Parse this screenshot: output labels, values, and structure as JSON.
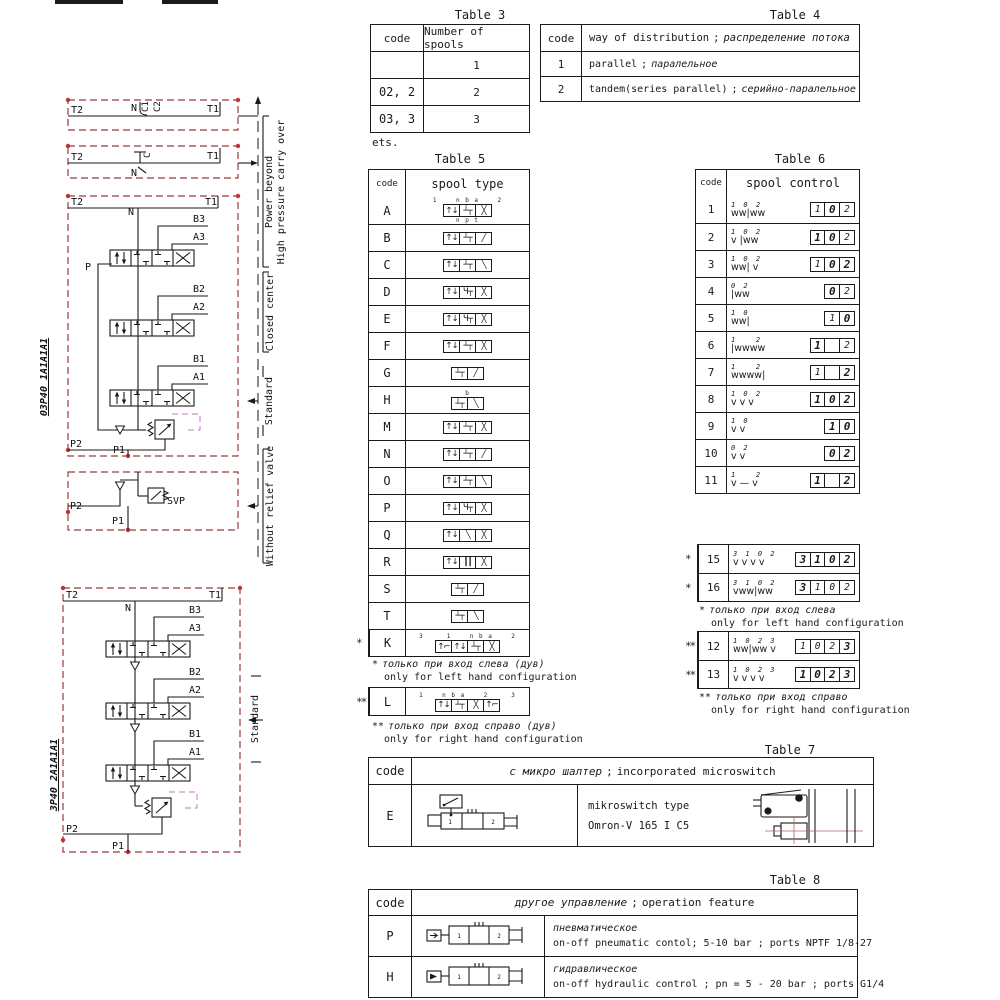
{
  "titles": {
    "t3": "Table 3",
    "t4": "Table 4",
    "t5": "Table 5",
    "t6": "Table 6",
    "t7": "Table 7",
    "t8": "Table 8"
  },
  "misc": {
    "sep": ";",
    "v1": "1",
    "v2": "2"
  },
  "colors": {
    "line": "#1a1a1a",
    "diagram_dash_red": "#9c3a3a",
    "port_dot_red": "#c23232",
    "relief_magenta": "#cf8fd0"
  },
  "table3": {
    "headers": [
      "code",
      "Number of spools"
    ],
    "rows": [
      [
        "",
        "1"
      ],
      [
        "02, 2",
        "2"
      ],
      [
        "03, 3",
        "3"
      ]
    ],
    "note": "ets."
  },
  "table4": {
    "headers": [
      "code"
    ],
    "header_en": "way of distribution",
    "header_ru": "распределение потока",
    "rows": [
      {
        "code": "1",
        "en": "parallel",
        "ru": "паралельное"
      },
      {
        "code": "2",
        "en": "tandem(series parallel)",
        "ru": "серийно-паралельное"
      }
    ]
  },
  "table5": {
    "headers": [
      "code",
      "spool type"
    ],
    "rows": [
      {
        "code": "A",
        "cells": [
          "ud",
          "blk",
          "x"
        ],
        "top": "1    n b a    2",
        "bottom": "n p t"
      },
      {
        "code": "B",
        "cells": [
          "ud",
          "blk",
          "fw"
        ]
      },
      {
        "code": "C",
        "cells": [
          "ud",
          "blk",
          "bw"
        ]
      },
      {
        "code": "D",
        "cells": [
          "ud",
          "hy",
          "x"
        ]
      },
      {
        "code": "E",
        "cells": [
          "ud",
          "hy",
          "x"
        ]
      },
      {
        "code": "F",
        "cells": [
          "ud",
          "blk",
          "x"
        ]
      },
      {
        "code": "G",
        "cells": [
          "blk",
          "fw"
        ]
      },
      {
        "code": "H",
        "cells": [
          "blk",
          "bw"
        ],
        "top": "b"
      },
      {
        "code": "M",
        "cells": [
          "ud",
          "blk",
          "x"
        ]
      },
      {
        "code": "N",
        "cells": [
          "ud",
          "blk",
          "fw"
        ]
      },
      {
        "code": "O",
        "cells": [
          "ud",
          "blk",
          "bw"
        ]
      },
      {
        "code": "P",
        "cells": [
          "ud",
          "hy",
          "x"
        ]
      },
      {
        "code": "Q",
        "cells": [
          "ud",
          "bw",
          "x"
        ]
      },
      {
        "code": "R",
        "cells": [
          "ud",
          "vl",
          "x"
        ]
      },
      {
        "code": "S",
        "cells": [
          "blk",
          "fw"
        ]
      },
      {
        "code": "T",
        "cells": [
          "blk",
          "bw"
        ]
      },
      {
        "code": "K",
        "cells": [
          "la",
          "ud",
          "blk",
          "x"
        ],
        "top": "3     1    n b a    2",
        "mark": "*"
      }
    ],
    "row_l": {
      "code": "L",
      "cells": [
        "ud",
        "blk",
        "x",
        "ra"
      ],
      "top": "1    n b a    2     3",
      "mark": "**"
    },
    "note_left": {
      "star": "*",
      "ru": "только при вход слева (дув)",
      "en": "only for left hand configuration"
    },
    "note_right": {
      "star": "**",
      "ru": "только при вход справо (дув)",
      "en": "only for right hand configuration"
    }
  },
  "table6": {
    "headers": [
      "code",
      "spool control"
    ],
    "rows": [
      {
        "code": "1",
        "sym": "ww|ww",
        "pos": "1 0 2",
        "off": 0,
        "boxes": [
          [
            "1",
            0
          ],
          [
            "0",
            1
          ],
          [
            "2",
            0
          ]
        ]
      },
      {
        "code": "2",
        "sym": "v |ww",
        "pos": "1 0 2",
        "off": 0,
        "boxes": [
          [
            "1",
            1
          ],
          [
            "0",
            1
          ],
          [
            "2",
            0
          ]
        ]
      },
      {
        "code": "3",
        "sym": "ww| v",
        "pos": "1 0 2",
        "off": 0,
        "boxes": [
          [
            "1",
            0
          ],
          [
            "0",
            1
          ],
          [
            "2",
            1
          ]
        ]
      },
      {
        "code": "4",
        "sym": "|ww",
        "pos": "0 2",
        "off": 1,
        "boxes": [
          [
            "0",
            1
          ],
          [
            "2",
            0
          ]
        ]
      },
      {
        "code": "5",
        "sym": "ww|",
        "pos": "1 0",
        "off": 0,
        "boxes": [
          [
            "1",
            0
          ],
          [
            "0",
            1
          ]
        ]
      },
      {
        "code": "6",
        "sym": "|wwww",
        "pos": "1   2",
        "off": 0,
        "boxes": [
          [
            "1",
            1
          ],
          [
            "",
            0
          ],
          [
            "2",
            0
          ]
        ]
      },
      {
        "code": "7",
        "sym": "wwww|",
        "pos": "1   2",
        "off": 0,
        "boxes": [
          [
            "1",
            0
          ],
          [
            "",
            0
          ],
          [
            "2",
            1
          ]
        ]
      },
      {
        "code": "8",
        "sym": "v v v",
        "pos": "1 0 2",
        "off": 0,
        "boxes": [
          [
            "1",
            1
          ],
          [
            "0",
            1
          ],
          [
            "2",
            1
          ]
        ]
      },
      {
        "code": "9",
        "sym": "v v",
        "pos": "1 0",
        "off": 0,
        "boxes": [
          [
            "1",
            1
          ],
          [
            "0",
            1
          ]
        ]
      },
      {
        "code": "10",
        "sym": "v v",
        "pos": "0 2",
        "off": 1,
        "boxes": [
          [
            "0",
            1
          ],
          [
            "2",
            1
          ]
        ]
      },
      {
        "code": "11",
        "sym": "v — v",
        "pos": "1   2",
        "off": 0,
        "boxes": [
          [
            "1",
            1
          ],
          [
            "",
            0
          ],
          [
            "2",
            1
          ]
        ]
      }
    ],
    "blockA": {
      "rows": [
        {
          "code": "15",
          "mark": "*",
          "sym": "v v v v",
          "pos": "3 1 0 2",
          "off": 0,
          "boxes": [
            [
              "3",
              1
            ],
            [
              "1",
              1
            ],
            [
              "0",
              1
            ],
            [
              "2",
              1
            ]
          ]
        },
        {
          "code": "16",
          "mark": "*",
          "sym": "vww|ww",
          "pos": "3 1 0 2",
          "off": 0,
          "boxes": [
            [
              "3",
              1
            ],
            [
              "1",
              0
            ],
            [
              "0",
              0
            ],
            [
              "2",
              0
            ]
          ]
        }
      ]
    },
    "note_a": {
      "star": "*",
      "ru": "только при вход слева",
      "en": "only for left hand configuration"
    },
    "blockB": {
      "rows": [
        {
          "code": "12",
          "mark": "**",
          "sym": "ww|ww v",
          "pos": "1 0 2 3",
          "off": 0,
          "boxes": [
            [
              "1",
              0
            ],
            [
              "0",
              0
            ],
            [
              "2",
              0
            ],
            [
              "3",
              1
            ]
          ]
        },
        {
          "code": "13",
          "mark": "**",
          "sym": "v v v v",
          "pos": "1 0 2 3",
          "off": 0,
          "boxes": [
            [
              "1",
              1
            ],
            [
              "0",
              1
            ],
            [
              "2",
              1
            ],
            [
              "3",
              1
            ]
          ]
        }
      ]
    },
    "note_b": {
      "star": "**",
      "ru": "только при вход справо",
      "en": "only for right hand configuration"
    }
  },
  "table7": {
    "code_header": "code",
    "header_ru": "с микро шалтер",
    "header_en": "incorporated microswitch",
    "row": {
      "code": "E",
      "line1": "mikroswitch type",
      "line2": "Omron-V 165 I C5"
    }
  },
  "table8": {
    "code_header": "code",
    "header_ru": "другое управление",
    "header_en": "operation feature",
    "rows": [
      {
        "code": "P",
        "ru": "пневматическое",
        "en": "on-off pneumatic contol; 5-10 bar ; ports NPTF 1/8-27"
      },
      {
        "code": "H",
        "ru": "гидравлическое",
        "en": "on-off hydraulic control ; pn = 5 - 20 bar ; ports G1/4"
      }
    ]
  },
  "circuits": {
    "d1": {
      "t2": "T2",
      "t1": "T1",
      "n": "N",
      "c1": "C1",
      "c2": "C2"
    },
    "d2": {
      "t2": "T2",
      "t1": "T1",
      "n": "N",
      "c": "C"
    },
    "d3": {
      "t2": "T2",
      "t1": "T1",
      "n": "N",
      "p": "P",
      "b3": "B3",
      "a3": "A3",
      "b2": "B2",
      "a2": "A2",
      "b1": "B1",
      "a1": "A1",
      "p2": "P2",
      "p1": "P1",
      "model": "03P40 1A1A1A1"
    },
    "d4": {
      "p2": "P2",
      "p1": "P1",
      "svp": "SVP"
    },
    "d5": {
      "t2": "T2",
      "t1": "T1",
      "n": "N",
      "b3": "B3",
      "a3": "A3",
      "b2": "B2",
      "a2": "A2",
      "b1": "B1",
      "a1": "A1",
      "p2": "P2",
      "p1": "P1",
      "model": "3P40 2A1A1A1"
    },
    "side": {
      "power_beyond": "Power beyond",
      "high_pressure": "High pressure carry over",
      "closed_center": "Closed center",
      "standard": "Standard",
      "without_relief": "Without relief valve",
      "standard2": "Standard"
    }
  }
}
